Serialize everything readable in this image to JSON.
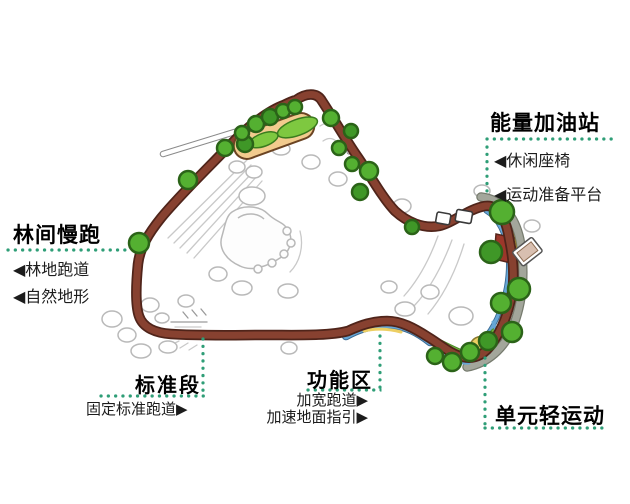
{
  "labels": {
    "energy_station": {
      "title": "能量加油站",
      "items": [
        "◀休闲座椅",
        "◀运动准备平台"
      ]
    },
    "forest_jog": {
      "title": "林间慢跑",
      "items": [
        "◀林地跑道",
        "◀自然地形"
      ]
    },
    "standard_section": {
      "title": "标准段",
      "items": [
        "固定标准跑道▶"
      ]
    },
    "functional_area": {
      "title": "功能区",
      "items": [
        "加宽跑道▶",
        "加速地面指引▶"
      ]
    },
    "light_sports": {
      "title": "单元轻运动",
      "items": []
    }
  },
  "colors": {
    "guide_dotted": "#2f9e77",
    "track": "#874130",
    "track_outline": "#4f241a",
    "lane_yellow": "#edcf63",
    "lane_blue": "#66a6d6",
    "lane_grey": "#a3a69b",
    "lawn_green": "#6cb53e",
    "tree_green": "#54b031",
    "platform_tan": "#f2cb8e",
    "label_text": "#000000"
  }
}
